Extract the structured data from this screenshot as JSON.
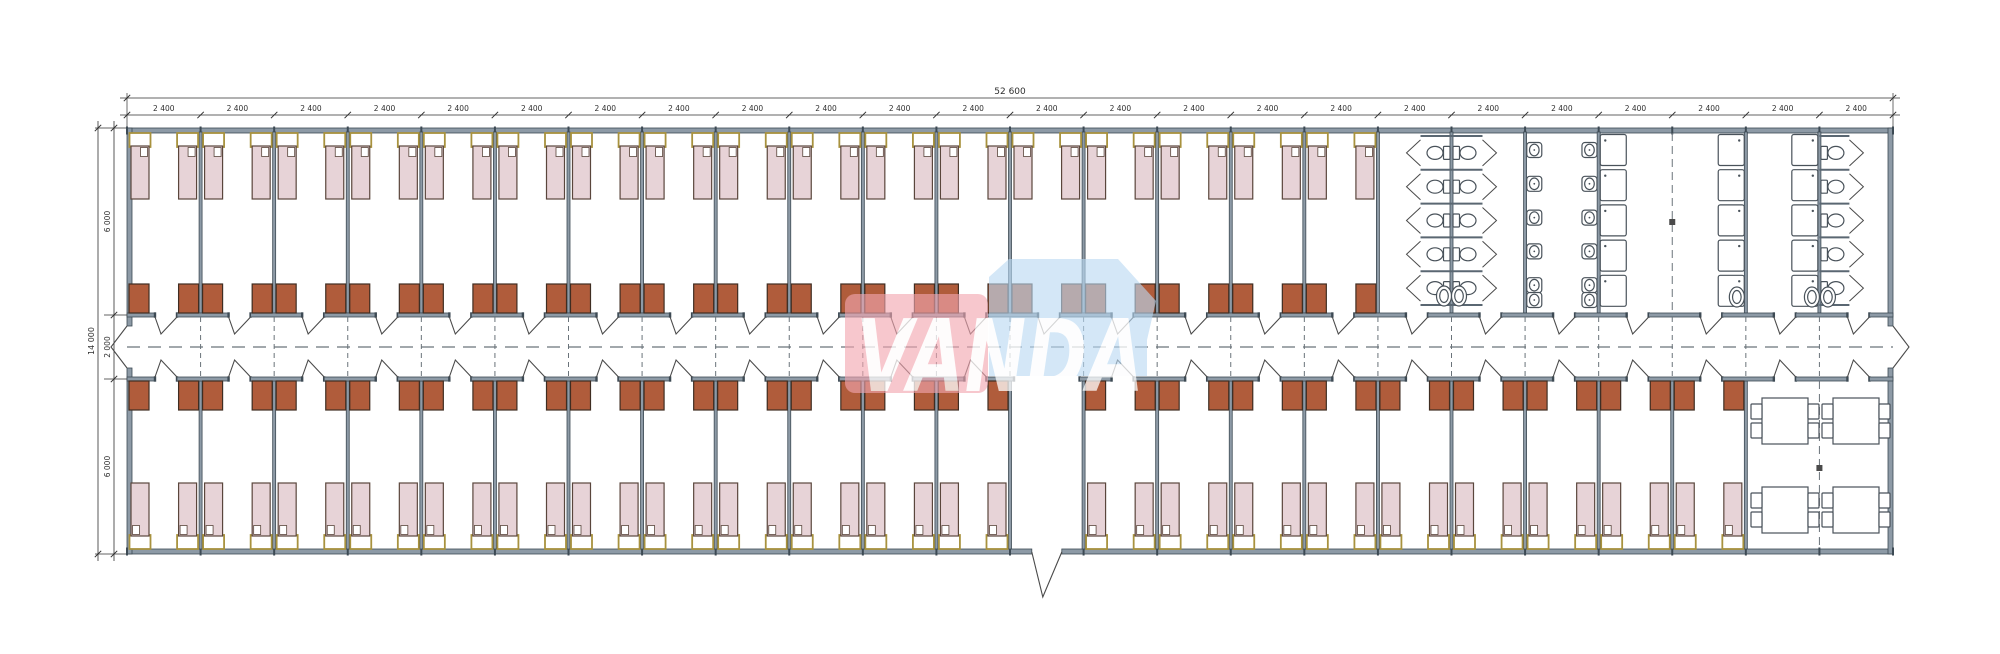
{
  "drawing": {
    "type": "architectural-floor-plan",
    "logo": {
      "text": "VANDA",
      "pink": "#f2a6b0",
      "blue": "#badaf2",
      "text_color": "#ffffff"
    },
    "dimensions": {
      "total_width_label": "52 600",
      "module_label": "2 400",
      "module_count": 24,
      "height_total_label": "14 000",
      "height_segment_labels": [
        "6 000",
        "2 000",
        "6 000"
      ]
    },
    "plan": {
      "top_band_bedroom_modules": 17,
      "bottom_band_bedroom_modules": 22,
      "vestibule_module_index": 12,
      "beds_per_room": 2,
      "wardrobes_per_room": 2,
      "toilet_stall_rows": 5,
      "basin_rows": 5,
      "shower_rows": 5,
      "dining_tables": 4,
      "chairs_per_table": 4
    },
    "colors": {
      "wall": "#8d9aa6",
      "wall_dark": "#3d4a54",
      "bed_fill": "#e7d3d7",
      "bed_stroke": "#5a463c",
      "headboard_stroke": "#a8923e",
      "wardrobe_fill": "#b05c3b",
      "wardrobe_stroke": "#3f2d22",
      "fixture_stroke": "#49525a",
      "door_stroke": "#4a4a4a",
      "dash": "#6a737a",
      "dim": "#2f2f2f"
    }
  }
}
